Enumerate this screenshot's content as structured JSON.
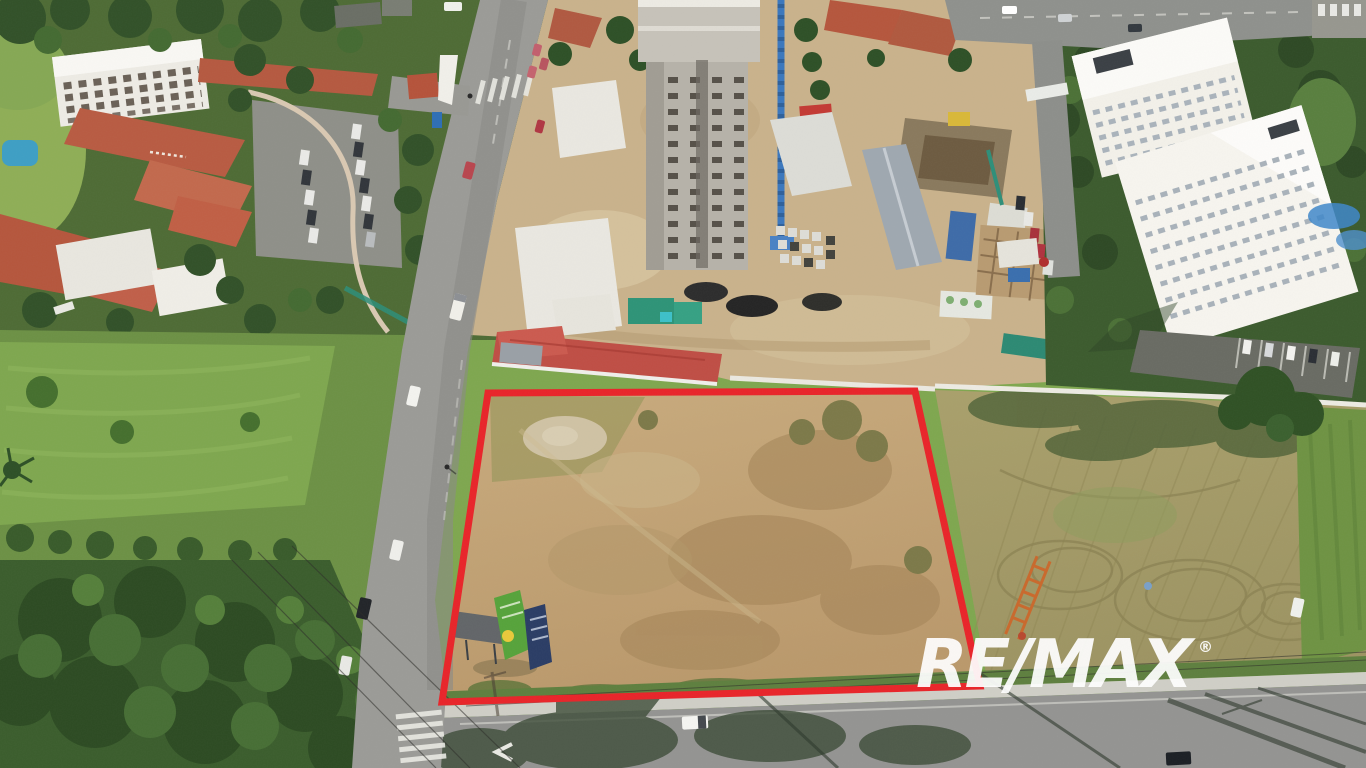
{
  "scene": {
    "type": "aerial-drone-photograph",
    "subject": "vacant-land-lot-outlined-for-sale"
  },
  "watermark": {
    "brand": "RE/MAX",
    "registered_mark": "®",
    "color": "#ffffff"
  },
  "property_boundary": {
    "points": "488,393 915,391 980,686 442,702",
    "color": "#e8262b",
    "stroke_width": "7"
  },
  "palette": {
    "dry_lot_grass": "#c2a376",
    "mowed_field": "#a59c68",
    "lawn_green": "#7fa750",
    "tree_green": "#3c5e2e",
    "asphalt": "#949492",
    "construction_dirt": "#c9b28c",
    "crane_blue": "#3c78bd",
    "tile_roof": "#b5573e",
    "warehouse_white": "#e9e7e0"
  }
}
